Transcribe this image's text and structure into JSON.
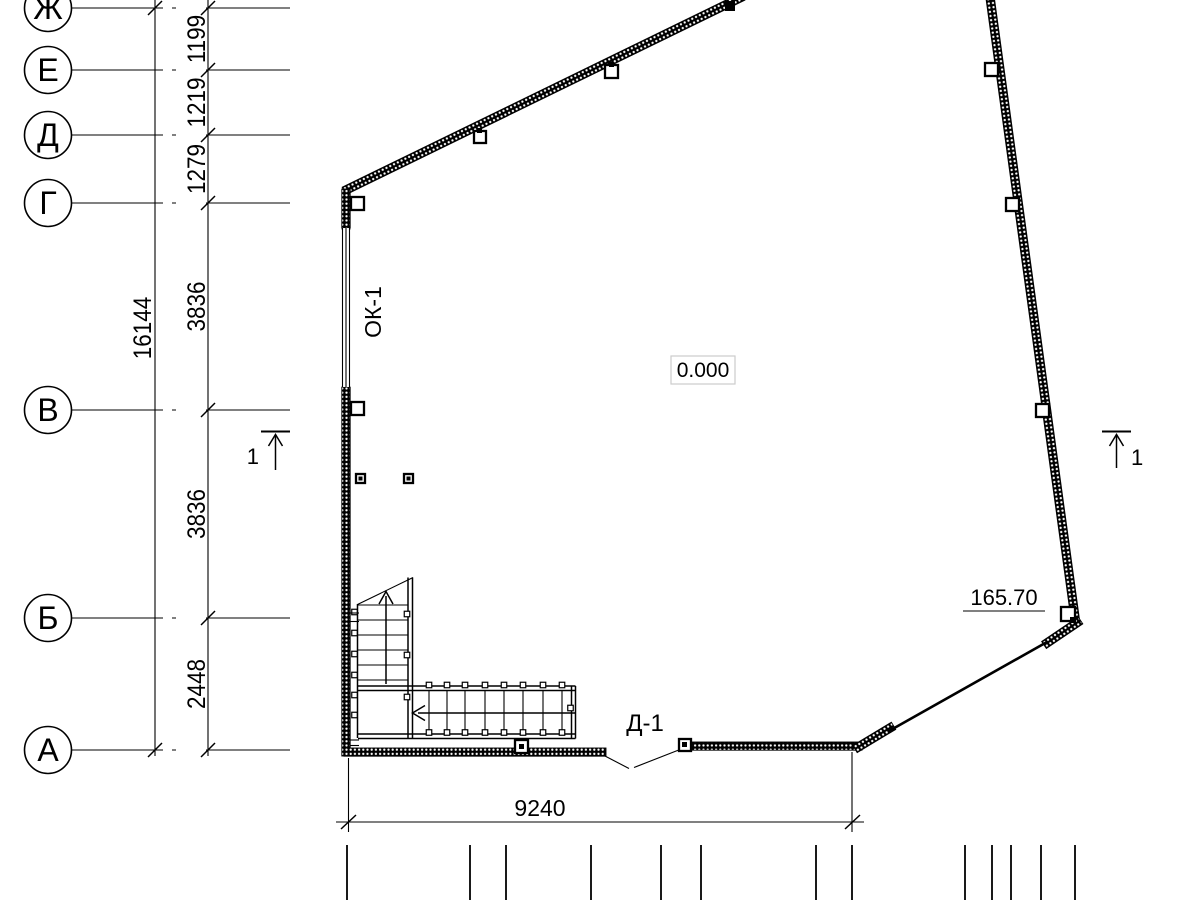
{
  "colors": {
    "line": "#000000",
    "background": "#ffffff",
    "level_box_border": "#cccccc"
  },
  "axes": [
    {
      "label": "Ж",
      "y": 8
    },
    {
      "label": "Е",
      "y": 70
    },
    {
      "label": "Д",
      "y": 135
    },
    {
      "label": "Г",
      "y": 203
    },
    {
      "label": "В",
      "y": 410
    },
    {
      "label": "Б",
      "y": 618
    },
    {
      "label": "А",
      "y": 750
    }
  ],
  "axis_dimensions": [
    {
      "value": "1199",
      "y": 39
    },
    {
      "value": "1219",
      "y": 102.5
    },
    {
      "value": "1279",
      "y": 169
    },
    {
      "value": "3836",
      "y": 306.5
    },
    {
      "value": "3836",
      "y": 514
    },
    {
      "value": "2448",
      "y": 684
    }
  ],
  "overall_dimension": {
    "value": "16144",
    "y": 328
  },
  "dimensions": {
    "bottom": {
      "value": "9240"
    }
  },
  "labels": {
    "window_mark": "ОК-1",
    "door_mark": "Д-1",
    "level_zero": "0.000",
    "level_upper": "165.70",
    "section": "1"
  },
  "geometry": {
    "axis_line": {
      "x1": 72,
      "x2": 290
    },
    "dim_line_1_x": 155,
    "dim_line_2_x": 208,
    "columns": [
      {
        "x": 351,
        "y": 197,
        "s": 13
      },
      {
        "x": 351,
        "y": 402,
        "s": 13
      },
      {
        "x": 474,
        "y": 131,
        "s": 12,
        "dot": {
          "x": 477,
          "y": 128,
          "s": 5
        }
      },
      {
        "x": 605,
        "y": 65,
        "s": 13,
        "dot": {
          "x": 609,
          "y": 62,
          "s": 5
        }
      },
      {
        "x": 725,
        "y": 1,
        "s": 10,
        "filled": true
      },
      {
        "x": 985,
        "y": 63,
        "s": 13
      },
      {
        "x": 1006,
        "y": 198,
        "s": 13
      },
      {
        "x": 1036,
        "y": 404,
        "s": 13
      },
      {
        "x": 1061,
        "y": 607,
        "s": 14,
        "dot": {
          "x": 1070,
          "y": 617,
          "s": 6
        }
      },
      {
        "x": 515,
        "y": 740,
        "s": 13,
        "dot": {
          "x": 519,
          "y": 744,
          "s": 5
        }
      },
      {
        "x": 679,
        "y": 739,
        "s": 12,
        "dot": {
          "x": 682,
          "y": 742,
          "s": 5
        }
      },
      {
        "x": 356,
        "y": 474,
        "s": 9,
        "dot": {
          "x": 358.5,
          "y": 476.5,
          "s": 4
        }
      },
      {
        "x": 404,
        "y": 474,
        "s": 9,
        "dot": {
          "x": 406.5,
          "y": 476.5,
          "s": 4
        }
      }
    ],
    "bottom_ticks": {
      "y1": 845,
      "y2": 901,
      "xs": [
        347,
        470,
        506,
        591,
        661,
        701,
        816,
        852,
        965,
        992,
        1011,
        1041,
        1075
      ]
    },
    "stairs": {
      "tread_x1": 358,
      "tread_x2": 408,
      "upper_treads_y": [
        605,
        620,
        635,
        650,
        665,
        680
      ],
      "lower_treads_x": [
        429,
        447,
        465,
        485,
        504,
        523,
        543,
        562
      ],
      "lower_y1": 691,
      "lower_y2": 734,
      "upper_balusters_x": 354.5,
      "upper_balusters_y": [
        612,
        633,
        654,
        675,
        695,
        715
      ],
      "right_edge_balusters_x": 407,
      "right_edge_balusters_y": [
        614,
        655,
        697
      ],
      "lower_balusters_top_y": 685,
      "lower_balusters_bottom_y": 732.5,
      "end_baluster": {
        "x": 570.5,
        "y": 708
      }
    }
  }
}
